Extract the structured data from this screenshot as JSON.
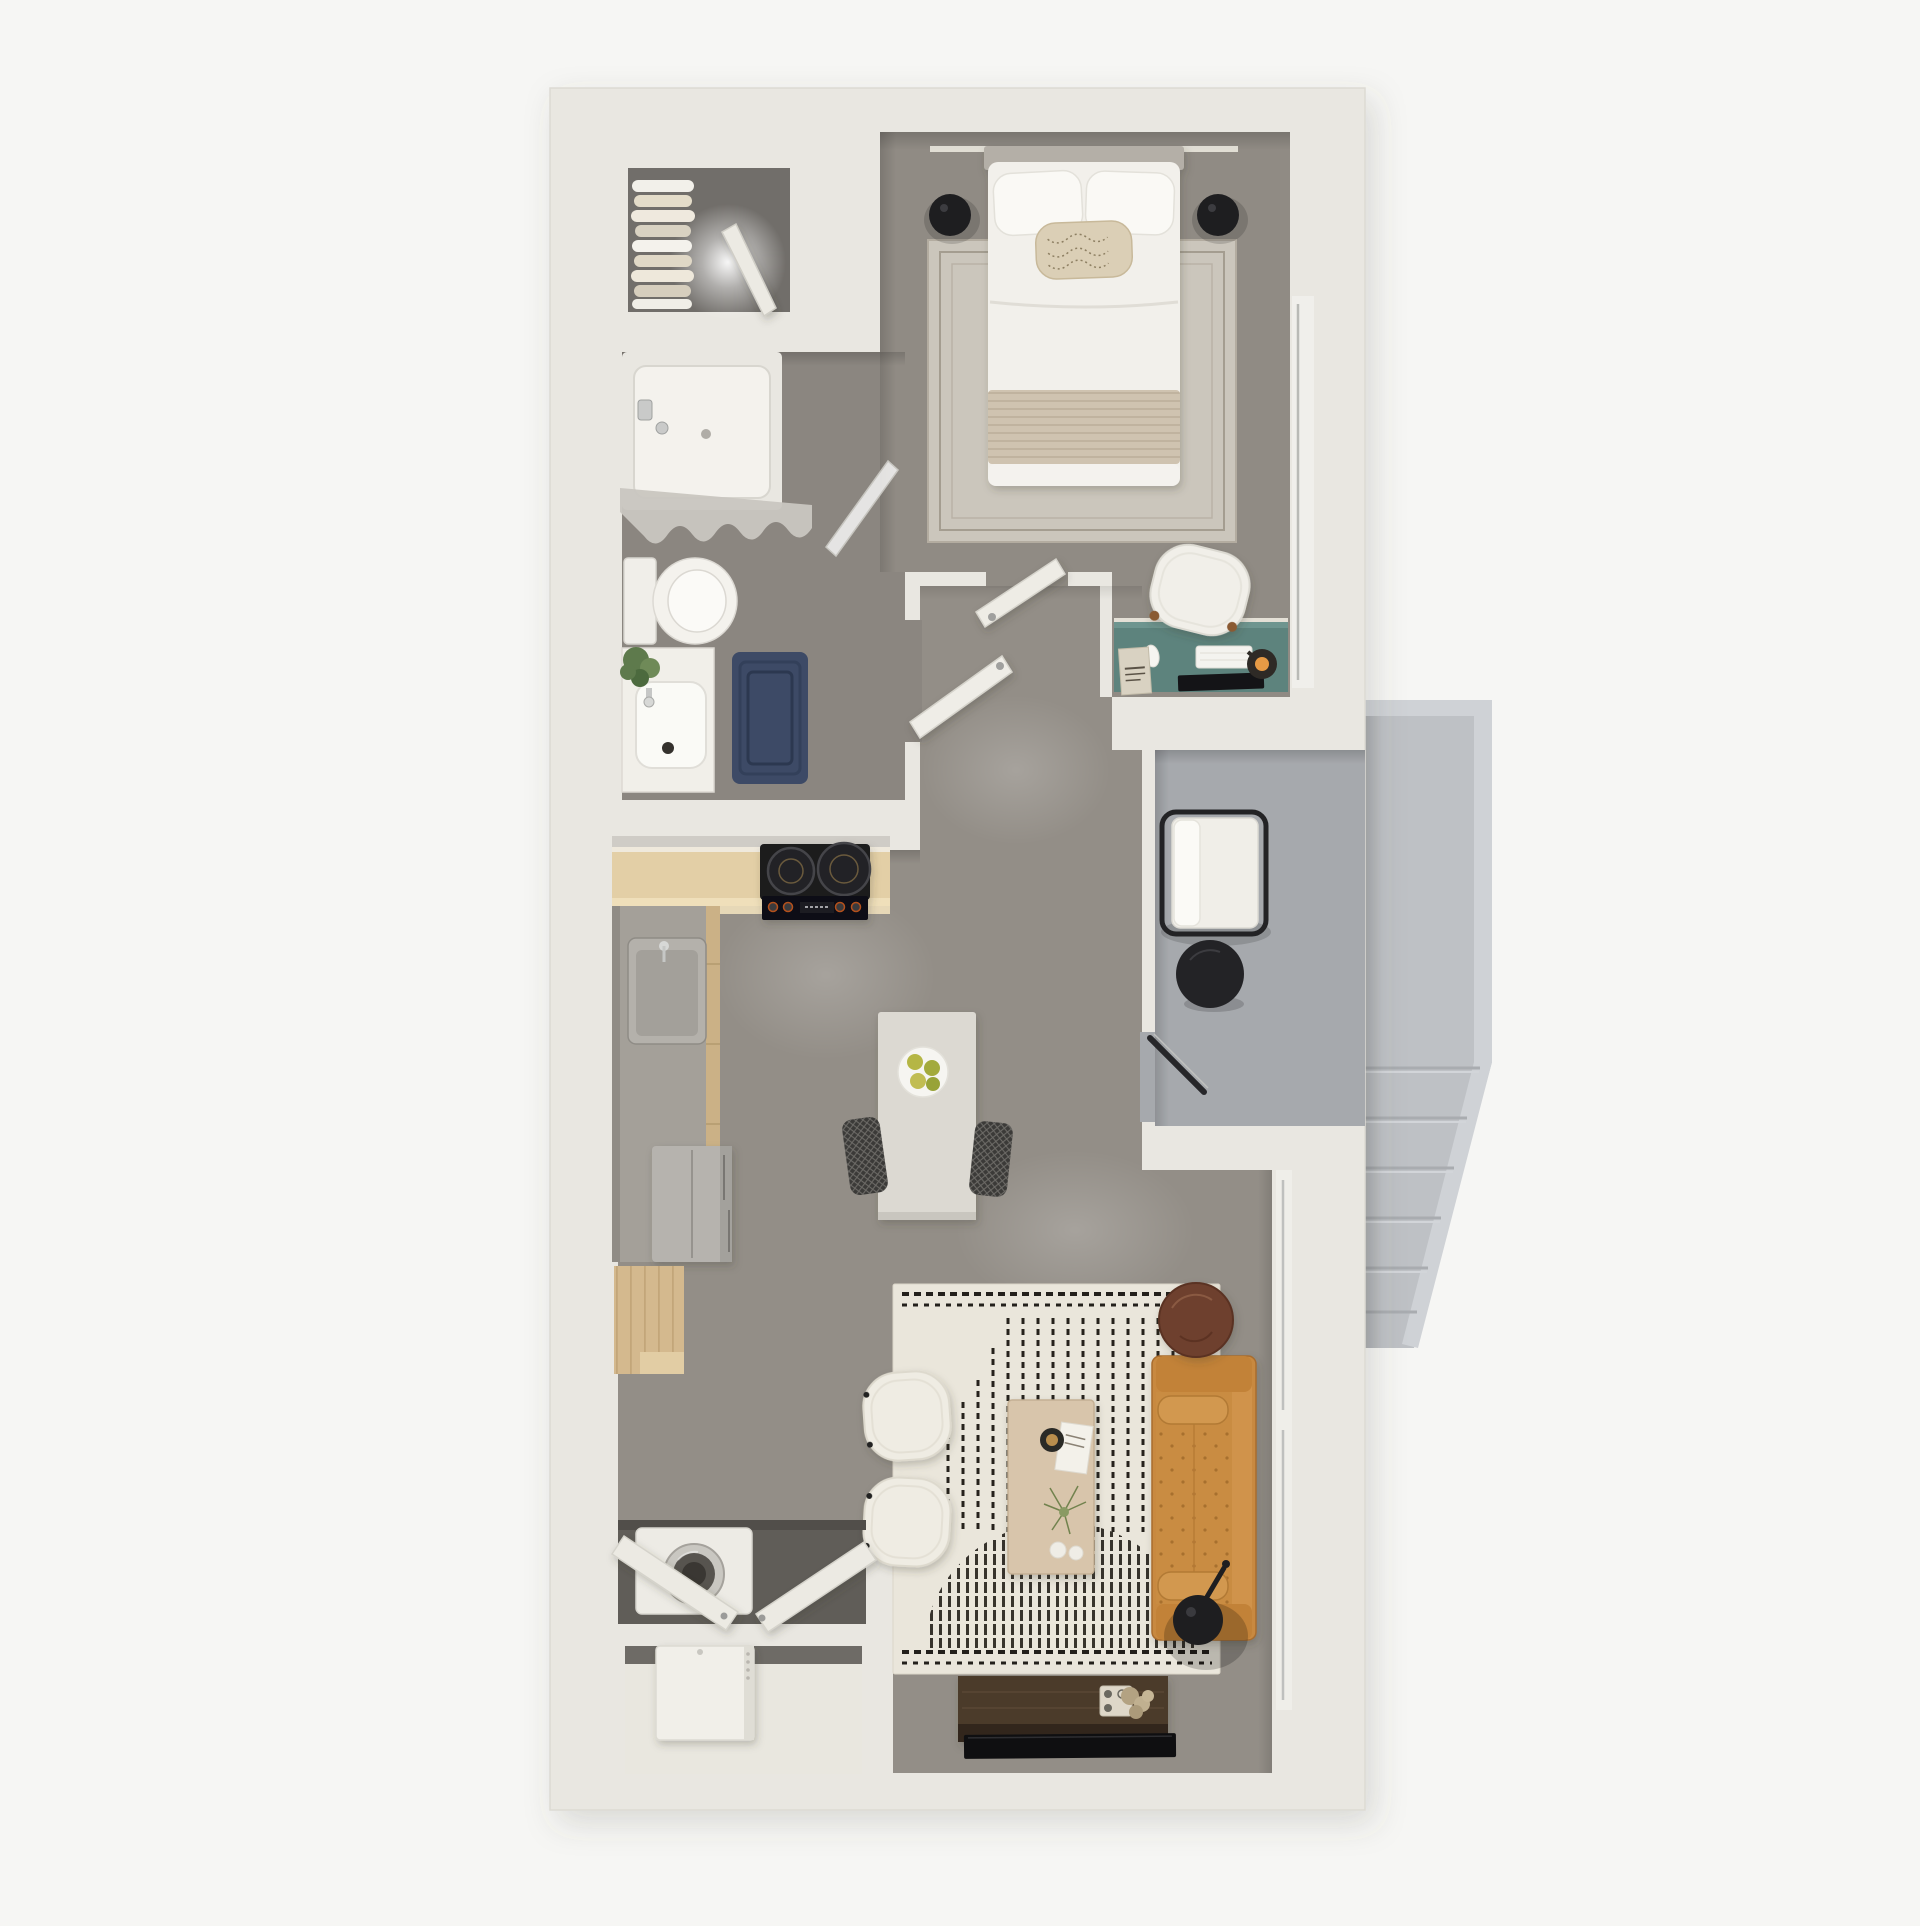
{
  "scene": {
    "type": "3d-floor-plan-render",
    "view": "top-down",
    "description": "Furnished one-bedroom apartment 3D floor plan with balcony and exterior stair landing"
  },
  "colors": {
    "background": "#f6f6f4",
    "wall": "#e9e7e1",
    "wall_edge": "#dcdad3",
    "floor_main": "#938e87",
    "floor_bedroom": "#908b84",
    "floor_bath": "#8b8680",
    "floor_closet": "#716e6a",
    "floor_laundry": "#605d58",
    "balcony_floor": "#a6a9ad",
    "landing": "#bec1c5",
    "landing_curb": "#cfd2d6",
    "rug_bedroom": "#cbc6bc",
    "rug_living": "#eae6db",
    "rug_pattern": "#26221c",
    "bath_mat": "#3d4a66",
    "desk": "#5d837d",
    "sofa": "#c8893f",
    "side_table": "#6e3f2e",
    "coffee_table": "#d8c5ab",
    "island": "#dcd9d2",
    "counter_wood": "#e3cfa6",
    "counter_gray": "#a4a099",
    "cabinet_wood": "#cbb186",
    "pantry": "#d4b98e",
    "stove": "#1a1a1d",
    "fridge": "#b6b3ae",
    "stool": "#3b3a38",
    "console": "#4b3a2b",
    "tv": "#0f0f11",
    "lamp": "#1e1e20",
    "chair_cream": "#efece3",
    "cushion": "#f0eee8",
    "bed_white": "#f2f0eb",
    "throw": "#cfc3b0",
    "headboard": "#b4afa7",
    "door": "#eceae3",
    "plant": "#5e7a4c",
    "washer": "#edebe5",
    "heater": "#f1efe9",
    "curtain": "#c9c6c0",
    "porcelain": "#f4f2ed"
  },
  "rooms": [
    {
      "id": "walk-in-closet",
      "furniture": [
        "hanging-clothes",
        "closet-door",
        "ceiling-spotlight"
      ]
    },
    {
      "id": "bathroom",
      "furniture": [
        "bathtub",
        "shower-curtain",
        "glass-screen",
        "toilet",
        "vanity-sink",
        "potted-plant",
        "bath-mat",
        "bathroom-door"
      ]
    },
    {
      "id": "bedroom",
      "furniture": [
        "double-bed",
        "pillows",
        "accent-pillow",
        "throw-blanket",
        "area-rug",
        "bedside-lamp-left",
        "bedside-lamp-right",
        "bedroom-door",
        "window"
      ]
    },
    {
      "id": "desk-nook",
      "furniture": [
        "desk",
        "desk-chair",
        "keyboard",
        "mouse",
        "monitor",
        "desk-lamp",
        "magazine"
      ]
    },
    {
      "id": "hallway",
      "furniture": []
    },
    {
      "id": "kitchen",
      "furniture": [
        "counter",
        "cooktop",
        "sink",
        "refrigerator",
        "pantry-cabinet"
      ]
    },
    {
      "id": "dining-area",
      "furniture": [
        "island-table",
        "fruit-plate",
        "bar-stool-left",
        "bar-stool-right"
      ]
    },
    {
      "id": "living-room",
      "furniture": [
        "area-rug",
        "armchair-left",
        "armchair-right",
        "coffee-table",
        "coffee-table-decor",
        "sofa",
        "side-table",
        "floor-lamp",
        "media-console",
        "tv",
        "window"
      ]
    },
    {
      "id": "laundry-closet",
      "furniture": [
        "washer",
        "bifold-door-left",
        "bifold-door-right"
      ]
    },
    {
      "id": "utility-closet",
      "furniture": [
        "water-heater"
      ]
    },
    {
      "id": "balcony",
      "furniture": [
        "lounge-chair",
        "round-side-table",
        "balcony-door"
      ]
    },
    {
      "id": "exterior-landing",
      "furniture": [
        "stairs"
      ]
    }
  ]
}
